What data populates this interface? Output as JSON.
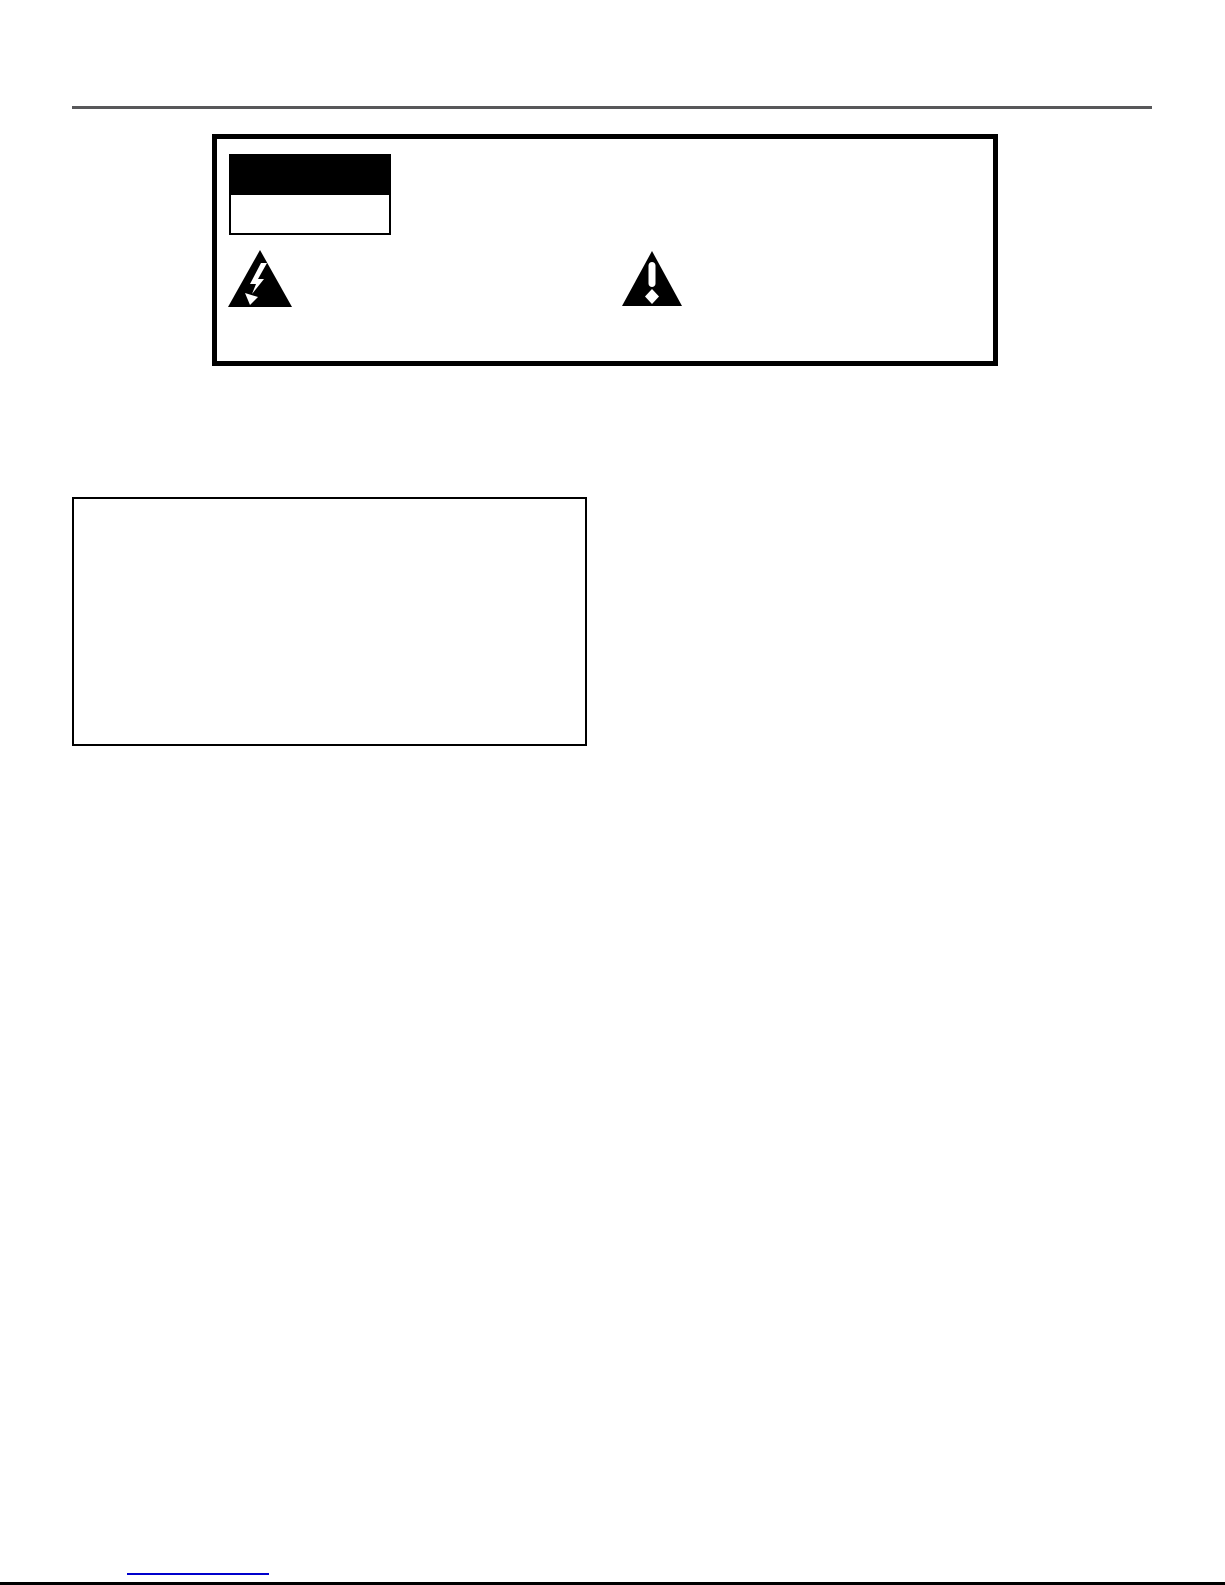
{
  "page": {
    "background": "#ffffff",
    "top_divider_color": "#58585a",
    "bottom_edge_color": "#000000",
    "link_underline_color": "#0000cc"
  },
  "warning_panel": {
    "fill": "#ffffff",
    "border_color": "#000000",
    "title_block_fill": "#000000",
    "subtitle_block_fill": "#ffffff",
    "subtitle_block_border_color": "#000000",
    "icons": {
      "high_voltage": {
        "triangle_fill": "#000000",
        "glyph_fill": "#ffffff"
      },
      "alert": {
        "triangle_fill": "#000000",
        "glyph_fill": "#ffffff"
      }
    }
  },
  "note_box": {
    "fill": "#ffffff",
    "border_color": "#000000"
  }
}
